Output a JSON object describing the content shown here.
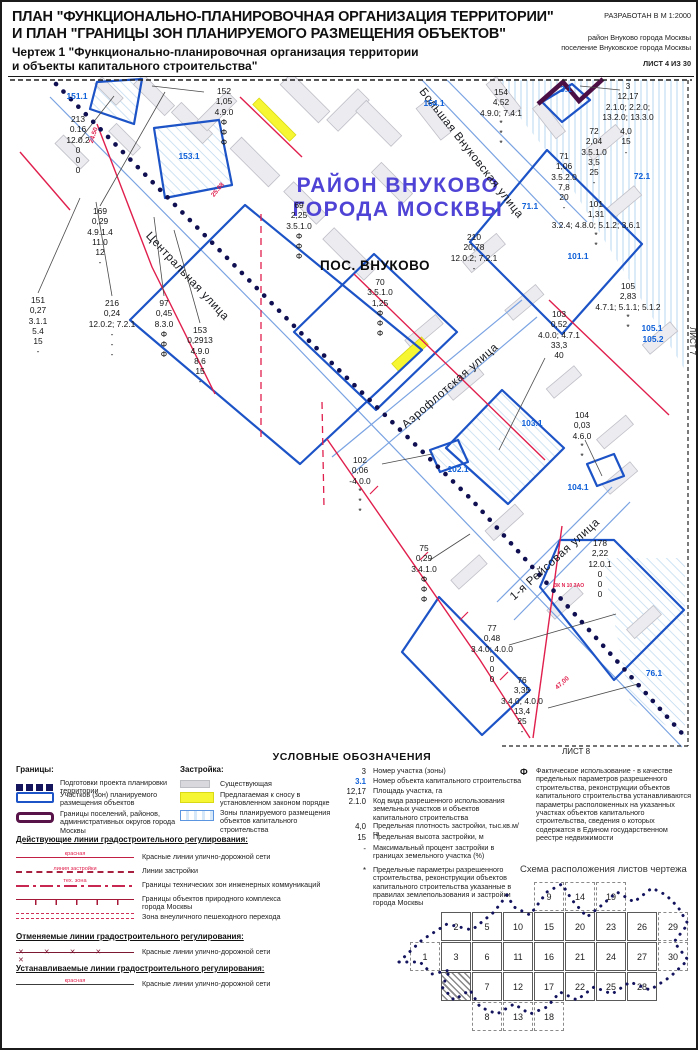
{
  "header": {
    "title_line1": "ПЛАН \"ФУНКЦИОНАЛЬНО-ПЛАНИРОВОЧНАЯ ОРГАНИЗАЦИЯ ТЕРРИТОРИИ\"",
    "title_line2": "И ПЛАН \"ГРАНИЦЫ ЗОН ПЛАНИРУЕМОГО РАЗМЕЩЕНИЯ ОБЪЕКТОВ\"",
    "scale_note": "РАЗРАБОТАН В М 1:2000",
    "subtitle_line1": "Чертеж 1 \"Функционально-планировочная организация территории",
    "subtitle_line2": "и объекты капитального строительства\"",
    "district_note1": "район Внуково города Москвы",
    "district_note2": "поселение Внуковское города Москвы",
    "sheet_note": "ЛИСТ 4 ИЗ 30"
  },
  "colors": {
    "parcel_blue": "#1c53c6",
    "zone_label_blue": "#0e5fd8",
    "red_line": "#e01f4d",
    "district_title_purple": "#4f43d6",
    "settlement_boundary_purple": "#4c0f45",
    "planning_boundary_navy": "#0f0f52",
    "demolition_yellow": "#f6f632"
  },
  "map": {
    "edge_labels": {
      "top": "ЛИСТ 3",
      "right": "ЛИСТ 7",
      "bottom": "ЛИСТ 8"
    },
    "region_line1": "РАЙОН ВНУКОВО",
    "region_line2": "ГОРОДА МОСКВЫ",
    "settlement_label": "ПОС. ВНУКОВО",
    "streets": [
      {
        "name": "Центральная улица"
      },
      {
        "name": "Большая Внуковская улица"
      },
      {
        "name": "Аэрофлотская улица"
      },
      {
        "name": "1-я Рейсовая улица"
      }
    ],
    "zone_labels": [
      "151.1",
      "153.1",
      "154.1",
      "3.1",
      "71.1",
      "72.1",
      "101.1",
      "105.1",
      "105.2",
      "103.1",
      "102.1",
      "104.1",
      "76.1"
    ],
    "annotations": {
      "p213": [
        "213",
        "0.16",
        "12.0.2",
        "0",
        "0",
        "0"
      ],
      "p152": [
        "152",
        "1,05",
        "4.9.0",
        "Ф",
        "Ф",
        "Ф"
      ],
      "p169": [
        "169",
        "0,29",
        "4.9.1.4",
        "11.0",
        "12",
        "-"
      ],
      "p151": [
        "151",
        "0,27",
        "3.1.1",
        "5.4",
        "15",
        "-"
      ],
      "p216": [
        "216",
        "0,24",
        "12.0.2; 7.2.1",
        "-",
        "-",
        "-"
      ],
      "p97": [
        "97",
        "0,45",
        "8.3.0",
        "Ф",
        "Ф",
        "Ф"
      ],
      "p153": [
        "153",
        "0,2913",
        "4.9.0",
        "8,6",
        "15",
        "-"
      ],
      "p69": [
        "69",
        "2,25",
        "3.5.1.0",
        "Ф",
        "Ф",
        "Ф"
      ],
      "p70": [
        "70",
        "3.5.1.0",
        "1,25",
        "Ф",
        "Ф",
        "Ф"
      ],
      "p210": [
        "210",
        "20,78",
        "12.0.2; 7.2.1",
        "-"
      ],
      "p154": [
        "154",
        "4,52",
        "4.9.0; 7.4.1",
        "*",
        "*",
        "*"
      ],
      "p3": [
        "3",
        "12,17",
        "2.1.0; 2.2.0;",
        "13.2.0; 13.3.0"
      ],
      "p72": [
        "72",
        "2,04",
        "3.5.1.0",
        "3,5",
        "25",
        "-"
      ],
      "p72b": [
        "4,0",
        "15",
        "-"
      ],
      "p71": [
        "71",
        "1,06",
        "3.5.2.0",
        "7,8",
        "20",
        "-"
      ],
      "p101": [
        "101",
        "1,31",
        "3.2.4; 4.8.0; 5.1.2; 3.6.1",
        "*",
        "*"
      ],
      "p105": [
        "105",
        "2,83",
        "4.7.1; 5.1.1; 5.1.2",
        "*",
        "*"
      ],
      "p103": [
        "103",
        "0,52",
        "4.0.0; 4.7.1",
        "33,3",
        "40"
      ],
      "p104": [
        "104",
        "0,03",
        "4.6.0",
        "*",
        "*"
      ],
      "p102": [
        "102",
        "0,06",
        "-4.0.0",
        "*",
        "*",
        "*"
      ],
      "p75": [
        "75",
        "0,29",
        "3.4.1.0",
        "Ф",
        "Ф",
        "Ф"
      ],
      "p178": [
        "178",
        "2,22",
        "12.0.1",
        "0",
        "0",
        "0"
      ],
      "p77": [
        "77",
        "0,48",
        "3.4.0; 4.0.0",
        "0",
        "0",
        "0"
      ],
      "p76": [
        "76",
        "3,35",
        "3.4.0; 4.0.0",
        "13,4",
        "25",
        "-"
      ]
    },
    "dims": {
      "d24": "24.50",
      "d25": "25.08",
      "d47": "47,00",
      "zk": "ЗК N 10 ЗАО"
    }
  },
  "legend": {
    "title": "УСЛОВНЫЕ ОБОЗНАЧЕНИЯ",
    "borders_title": "Границы:",
    "borders": [
      {
        "label": "Подготовки проекта планировки территории"
      },
      {
        "label": "Участков (зон) планируемого размещения объектов"
      },
      {
        "label": "Границы поселений, районов, административных округов города Москвы"
      }
    ],
    "buildings_title": "Застройка:",
    "buildings": [
      {
        "label": "Существующая"
      },
      {
        "label": "Предлагаемая к сносу в установленном законом порядке"
      },
      {
        "label": "Зоны планируемого размещения объектов капитального строительства"
      }
    ],
    "active_title": "Действующие линии градостроительного регулирования:",
    "active": [
      {
        "tag": "красная",
        "label": "Красные линии улично-дорожной сети"
      },
      {
        "tag": "линия застройки",
        "label": "Линии застройки"
      },
      {
        "tag": "тех. зона",
        "label": "Границы технических зон инженерных коммуникаций"
      },
      {
        "tag": "",
        "label": "Границы объектов природного комплекса города Москвы"
      },
      {
        "tag": "",
        "label": "Зона внеуличного пешеходного перехода"
      }
    ],
    "cancelled_title": "Отменяемые линии градостроительного регулирования:",
    "cancelled": [
      {
        "label": "Красные линии улично-дорожной сети"
      }
    ],
    "established_title": "Устанавливаемые линии градостроительного регулирования:",
    "established": [
      {
        "tag": "красная",
        "label": "Красные линии улично-дорожной сети"
      }
    ],
    "params": [
      {
        "symbol": "3",
        "text": "Номер участка (зоны)"
      },
      {
        "symbol": "3.1",
        "text": "Номер объекта капитального строительства"
      },
      {
        "symbol": "12,17",
        "text": "Площадь участка, га"
      },
      {
        "symbol": "2.1.0",
        "text": "Код вида разрешенного использования земельных участков и объектов капитального строительства"
      },
      {
        "symbol": "4,0",
        "text": "Предельная плотность застройки, тыс.кв.м/га"
      },
      {
        "symbol": "15",
        "text": "Предельная высота застройки, м"
      },
      {
        "symbol": "-",
        "text": "Максимальный процент застройки в границах земельного участка (%)"
      },
      {
        "symbol": "*",
        "text": "Предельные параметры разрешенного строительства, реконструкции объектов капитального строительства указанные в правилах землепользования и застройки города Москвы"
      }
    ],
    "fact_note": {
      "symbol": "Ф",
      "text": "Фактическое использование - в качестве предельных параметров разрешенного строительства, реконструкции объектов капитального строительства устанавливаются параметры расположенных на указанных участках объектов капитального строительства, сведения о которых содержатся в Едином государственном реестре недвижимости"
    }
  },
  "scheme": {
    "title": "Схема расположения листов чертежа",
    "cells": [
      {
        "n": "9",
        "row": 0,
        "col": 4,
        "dashed": true
      },
      {
        "n": "14",
        "row": 0,
        "col": 5,
        "dashed": true
      },
      {
        "n": "19",
        "row": 0,
        "col": 6,
        "dashed": true
      },
      {
        "n": "2",
        "row": 1,
        "col": 1
      },
      {
        "n": "5",
        "row": 1,
        "col": 2
      },
      {
        "n": "10",
        "row": 1,
        "col": 3
      },
      {
        "n": "15",
        "row": 1,
        "col": 4
      },
      {
        "n": "20",
        "row": 1,
        "col": 5
      },
      {
        "n": "23",
        "row": 1,
        "col": 6
      },
      {
        "n": "26",
        "row": 1,
        "col": 7
      },
      {
        "n": "29",
        "row": 1,
        "col": 8,
        "dashed": true
      },
      {
        "n": "1",
        "row": 2,
        "col": 0,
        "dashed": true
      },
      {
        "n": "3",
        "row": 2,
        "col": 1
      },
      {
        "n": "6",
        "row": 2,
        "col": 2
      },
      {
        "n": "11",
        "row": 2,
        "col": 3
      },
      {
        "n": "16",
        "row": 2,
        "col": 4
      },
      {
        "n": "21",
        "row": 2,
        "col": 5
      },
      {
        "n": "24",
        "row": 2,
        "col": 6
      },
      {
        "n": "27",
        "row": 2,
        "col": 7
      },
      {
        "n": "30",
        "row": 2,
        "col": 8,
        "dashed": true
      },
      {
        "n": "4",
        "row": 3,
        "col": 1,
        "current": true
      },
      {
        "n": "7",
        "row": 3,
        "col": 2
      },
      {
        "n": "12",
        "row": 3,
        "col": 3
      },
      {
        "n": "17",
        "row": 3,
        "col": 4
      },
      {
        "n": "22",
        "row": 3,
        "col": 5
      },
      {
        "n": "25",
        "row": 3,
        "col": 6
      },
      {
        "n": "28",
        "row": 3,
        "col": 7
      },
      {
        "n": "8",
        "row": 4,
        "col": 2,
        "dashed": true
      },
      {
        "n": "13",
        "row": 4,
        "col": 3,
        "dashed": true
      },
      {
        "n": "18",
        "row": 4,
        "col": 4,
        "dashed": true
      }
    ]
  }
}
